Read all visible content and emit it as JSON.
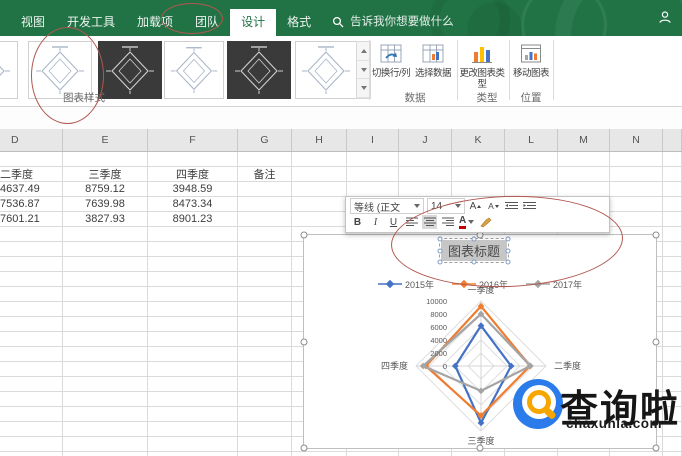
{
  "titlebar": {
    "tabs": [
      "视图",
      "开发工具",
      "加载项",
      "团队",
      "设计",
      "格式"
    ],
    "active_tab": "设计",
    "search_placeholder": "告诉我你想要做什么"
  },
  "ribbon": {
    "gallery_label": "图表样式",
    "gallery": {
      "thumbs": [
        {
          "style": "light"
        },
        {
          "style": "light"
        },
        {
          "style": "dark"
        },
        {
          "style": "light"
        },
        {
          "style": "dark"
        },
        {
          "style": "light"
        }
      ]
    },
    "groups": [
      {
        "label": "数据",
        "buttons": [
          "切换行/列",
          "选择数据"
        ]
      },
      {
        "label": "类型",
        "buttons": [
          "更改图表类型"
        ]
      },
      {
        "label": "位置",
        "buttons": [
          "移动图表"
        ]
      }
    ]
  },
  "mini_toolbar": {
    "font_name": "等线 (正文",
    "font_size": "14",
    "bold": "B",
    "italic": "I",
    "underline": "U",
    "grow_font": "A",
    "shrink_font": "A",
    "font_color": "A"
  },
  "sheet": {
    "columns": [
      "D",
      "E",
      "F",
      "G",
      "H",
      "I",
      "J",
      "K",
      "L",
      "M",
      "N",
      ""
    ],
    "rows": [
      {
        "cells": [
          "",
          "",
          "",
          "",
          "",
          "",
          "",
          "",
          "",
          "",
          "",
          ""
        ]
      },
      {
        "cells": [
          "二季度",
          "三季度",
          "四季度",
          "备注",
          "",
          "",
          "",
          "",
          "",
          "",
          "",
          ""
        ]
      },
      {
        "cells": [
          "4637.49",
          "8759.12",
          "3948.59",
          "",
          "",
          "",
          "",
          "",
          "",
          "",
          "",
          ""
        ]
      },
      {
        "cells": [
          "7536.87",
          "7639.98",
          "8473.34",
          "",
          "",
          "",
          "",
          "",
          "",
          "",
          "",
          ""
        ]
      },
      {
        "cells": [
          "7601.21",
          "3827.93",
          "8901.23",
          "",
          "",
          "",
          "",
          "",
          "",
          "",
          "",
          ""
        ]
      }
    ]
  },
  "chart": {
    "title": "图表标题"
  },
  "chart_data": {
    "type": "radar",
    "title": "图表标题",
    "categories": [
      "一季度",
      "二季度",
      "三季度",
      "四季度"
    ],
    "series": [
      {
        "name": "2015年",
        "color": "#4472C4",
        "values": [
          6200,
          4637.49,
          8759.12,
          3948.59
        ]
      },
      {
        "name": "2016年",
        "color": "#ED7D31",
        "values": [
          9200,
          7536.87,
          7639.98,
          8473.34
        ]
      },
      {
        "name": "2017年",
        "color": "#A5A5A5",
        "values": [
          8000,
          7601.21,
          3827.93,
          8901.23
        ]
      }
    ],
    "ticks": [
      0,
      2000,
      4000,
      6000,
      8000,
      10000
    ],
    "ylim": [
      0,
      10000
    ],
    "legend_position": "top"
  },
  "watermark": {
    "text": "查询啦",
    "domain": "chaxunla.com"
  },
  "colors": {
    "excel_green": "#217346",
    "annotation_red": "#b0574f",
    "series_blue": "#4472C4",
    "series_orange": "#ED7D31",
    "series_gray": "#A5A5A5"
  }
}
